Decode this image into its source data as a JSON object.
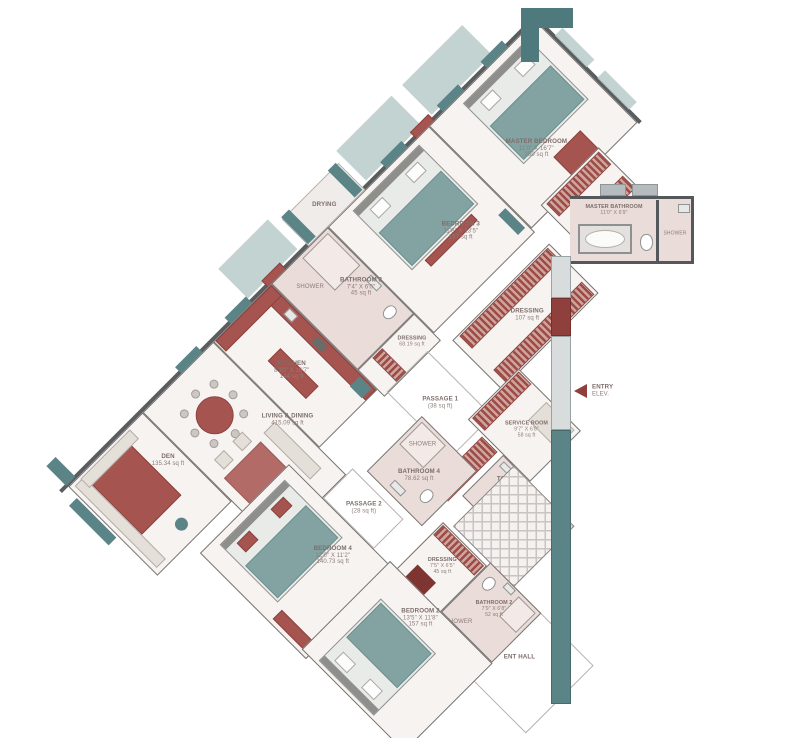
{
  "rooms": {
    "master_bedroom": {
      "name": "MASTER BEDROOM",
      "dims": "11'0\" X 16'7\"",
      "area": "250 sq ft"
    },
    "master_bathroom": {
      "name": "MASTER BATHROOM",
      "dims": "11'0\" X 6'9\""
    },
    "bedroom_3": {
      "name": "BEDROOM 3",
      "dims": "11'8\" X 13'5\"",
      "area": "157 sq ft"
    },
    "bathroom_3": {
      "name": "BATHROOM 3",
      "dims": "7'4\" X 6'0\"",
      "area": "45 sq ft"
    },
    "dressing_master": {
      "name": "DRESSING",
      "area": "107 sq ft"
    },
    "dressing_small": {
      "name": "DRESSING",
      "area": "68.19 sq ft"
    },
    "drying": {
      "name": "DRYING"
    },
    "kitchen": {
      "name": "KITCHEN",
      "dims": "8'10\" X 16'7\"",
      "area": "144 sq ft"
    },
    "passage_1": {
      "name": "PASSAGE 1",
      "area": "(38 sq ft)"
    },
    "living_dining": {
      "name": "LIVING & DINING",
      "area": "415.09 sq ft"
    },
    "den": {
      "name": "DEN",
      "area": "135.34 sq ft"
    },
    "service_room": {
      "name": "SERVICE ROOM",
      "dims": "9'7\" X 6'8\"",
      "area": "58 sq ft"
    },
    "toilet": {
      "name": "TOILET"
    },
    "bathroom_4": {
      "name": "BATHROOM 4",
      "area": "78.62 sq ft"
    },
    "passage_2": {
      "name": "PASSAGE 2",
      "area": "(28 sq ft)"
    },
    "bedroom_4": {
      "name": "BEDROOM 4",
      "dims": "12'0\" X 11'2\"",
      "area": "140.73 sq ft"
    },
    "dressing_bedroom4": {
      "name": "DRESSING",
      "dims": "7'5\" X 6'5\"",
      "area": "45 sq ft"
    },
    "bedroom_2": {
      "name": "BEDROOM 2",
      "dims": "13'5\" X 11'8\"",
      "area": "157 sq ft"
    },
    "bathroom_2": {
      "name": "BATHROOM 2",
      "dims": "7'9\" X 6'8\"",
      "area": "52 sq ft"
    },
    "ent_hall": {
      "name": "ENT HALL"
    },
    "entry": {
      "name": "ENTRY",
      "note": "ELEV."
    }
  },
  "labels": {
    "shower": "SHOWER"
  },
  "colors": {
    "wall": "#5a5d5f",
    "floor": "#f7f3f1",
    "bath_floor": "#eadcd9",
    "teal": "#5b8487",
    "teal_light": "#b7cbca",
    "red": "#a65450",
    "dark_red": "#8f3f3c",
    "stripe_red": "#9c4b47",
    "text": "#8d7c79"
  }
}
